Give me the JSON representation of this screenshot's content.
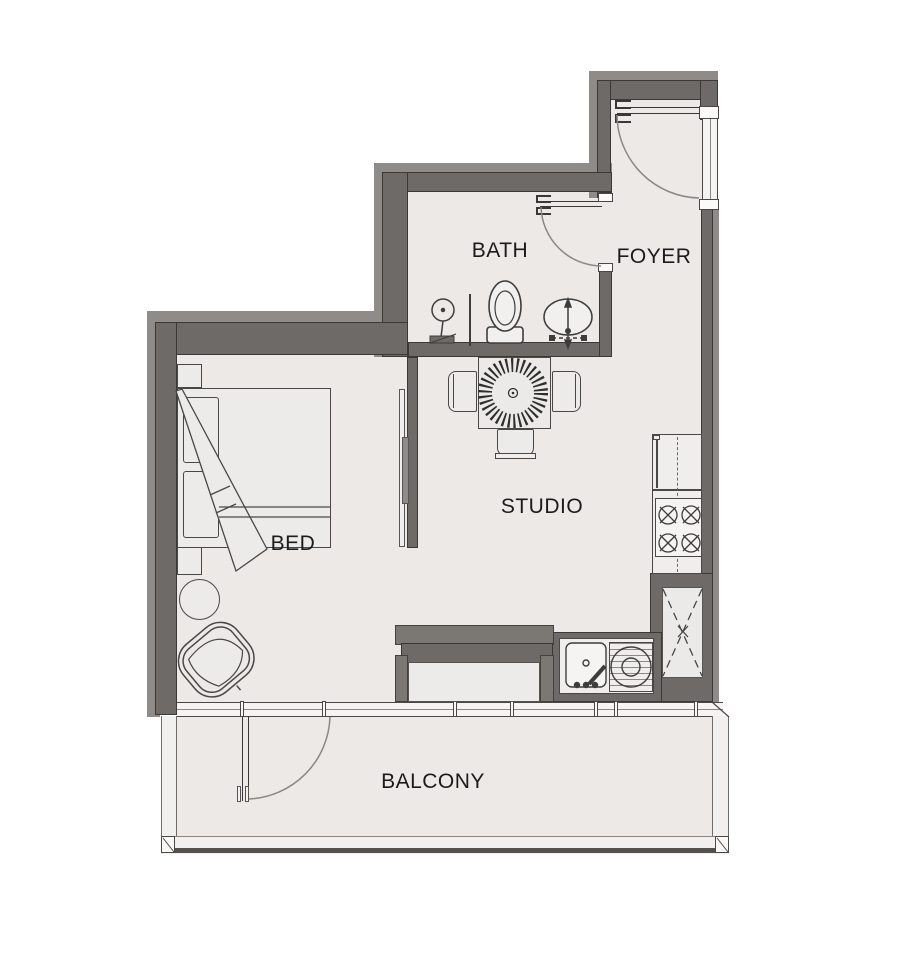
{
  "plan": {
    "title": "Studio apartment floor plan",
    "rooms": {
      "bath": "BATH",
      "foyer": "FOYER",
      "studio": "STUDIO",
      "bed": "BED",
      "balcony": "BALCONY"
    },
    "colors": {
      "wall-dark": "#6d6a67",
      "wall-light": "#8e8b89",
      "floor": "#ece9e7",
      "line": "#4a4846",
      "bg": "#ffffff",
      "text": "#1b1b1b"
    },
    "fixtures": [
      "entrance-door",
      "bath-door",
      "balcony-door",
      "sliding-door",
      "toilet",
      "shower",
      "bathroom-sink",
      "dining-table",
      "dining-chairs",
      "sunburst-rug",
      "bed",
      "pillows",
      "nightstands",
      "side-table",
      "armchair",
      "refrigerator",
      "stove-burners",
      "kitchen-sink",
      "drainboard",
      "service-shaft",
      "window-wall",
      "balcony-railing"
    ]
  }
}
